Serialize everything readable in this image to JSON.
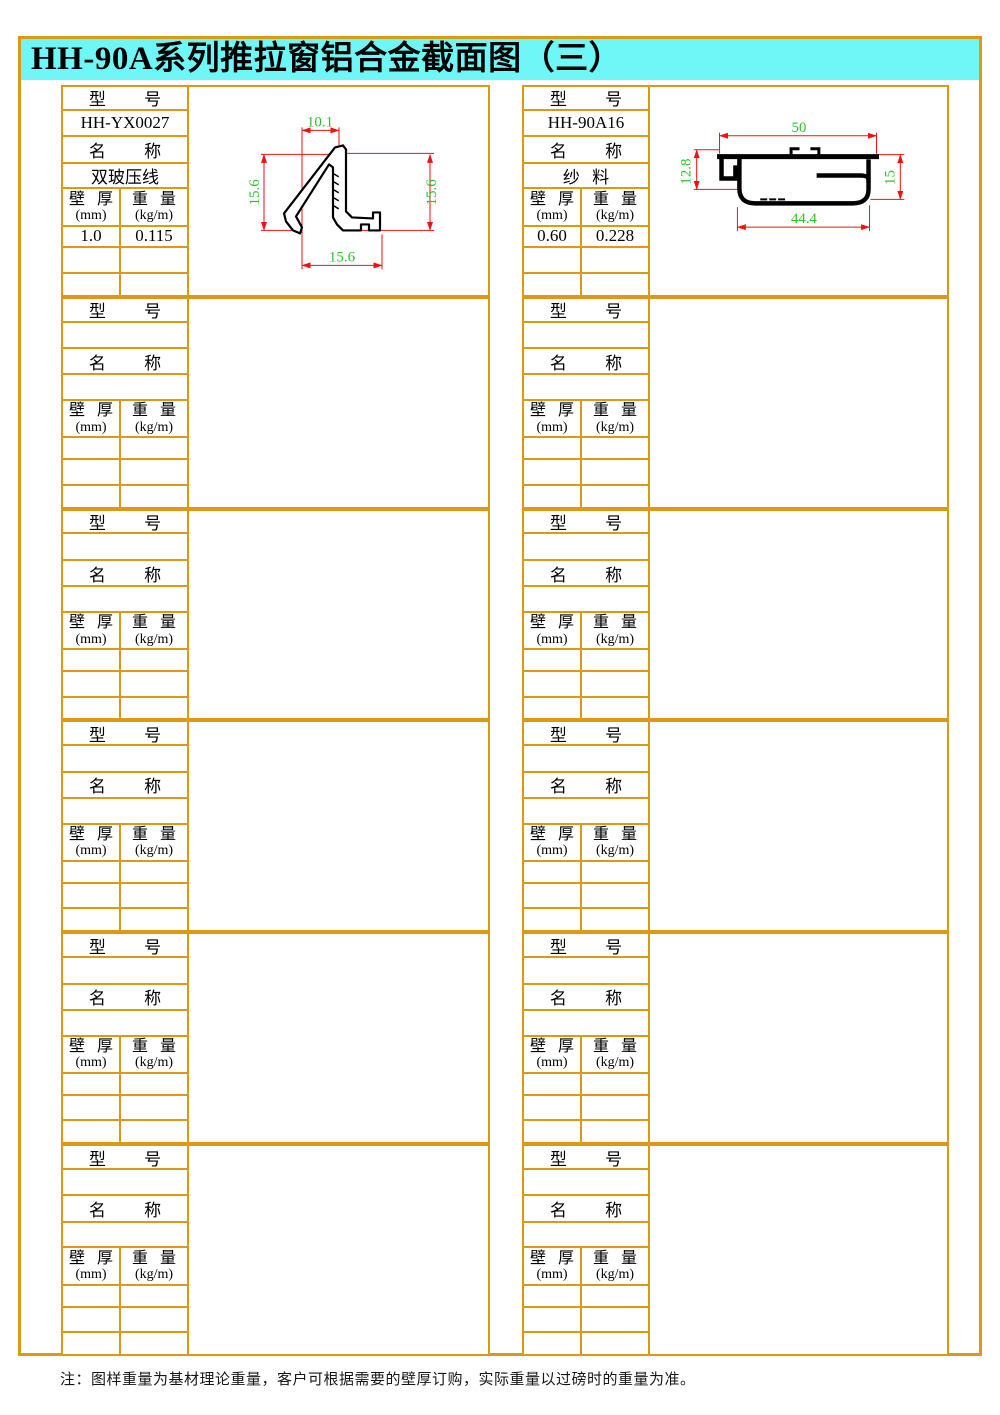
{
  "title": "HH-90A系列推拉窗铝合金截面图（三）",
  "note": "注：图样重量为基材理论重量，客户可根据需要的壁厚订购，实际重量以过磅时的重量为准。",
  "labels": {
    "model": "型 号",
    "name": "名 称",
    "thickness": "壁 厚",
    "thickness_unit": "(mm)",
    "weight": "重 量",
    "weight_unit": "(kg/m)"
  },
  "colors": {
    "grid_border": "#DD9914",
    "title_bg": "#6FF6F6",
    "dimension_line": "#F21010",
    "dimension_text": "#2EC22E",
    "profile_outline": "#000000"
  },
  "columns": [
    {
      "blocks": [
        {
          "model": "HH-YX0027",
          "name": "双玻压线",
          "thickness": "1.0",
          "weight": "0.115",
          "drawing": "yx0027"
        },
        {
          "model": "",
          "name": "",
          "thickness": "",
          "weight": ""
        },
        {
          "model": "",
          "name": "",
          "thickness": "",
          "weight": ""
        },
        {
          "model": "",
          "name": "",
          "thickness": "",
          "weight": ""
        },
        {
          "model": "",
          "name": "",
          "thickness": "",
          "weight": ""
        },
        {
          "model": "",
          "name": "",
          "thickness": "",
          "weight": ""
        }
      ]
    },
    {
      "blocks": [
        {
          "model": "HH-90A16",
          "name": "纱 料",
          "thickness": "0.60",
          "weight": "0.228",
          "drawing": "90a16"
        },
        {
          "model": "",
          "name": "",
          "thickness": "",
          "weight": ""
        },
        {
          "model": "",
          "name": "",
          "thickness": "",
          "weight": ""
        },
        {
          "model": "",
          "name": "",
          "thickness": "",
          "weight": ""
        },
        {
          "model": "",
          "name": "",
          "thickness": "",
          "weight": ""
        },
        {
          "model": "",
          "name": "",
          "thickness": "",
          "weight": ""
        }
      ]
    }
  ],
  "drawings": {
    "yx0027": {
      "dim_top": "10.1",
      "dim_left": "15.6",
      "dim_right": "15.6",
      "dim_bottom": "15.6"
    },
    "90a16": {
      "dim_top": "50",
      "dim_left": "12.8",
      "dim_right": "15",
      "dim_bottom": "44.4"
    }
  }
}
